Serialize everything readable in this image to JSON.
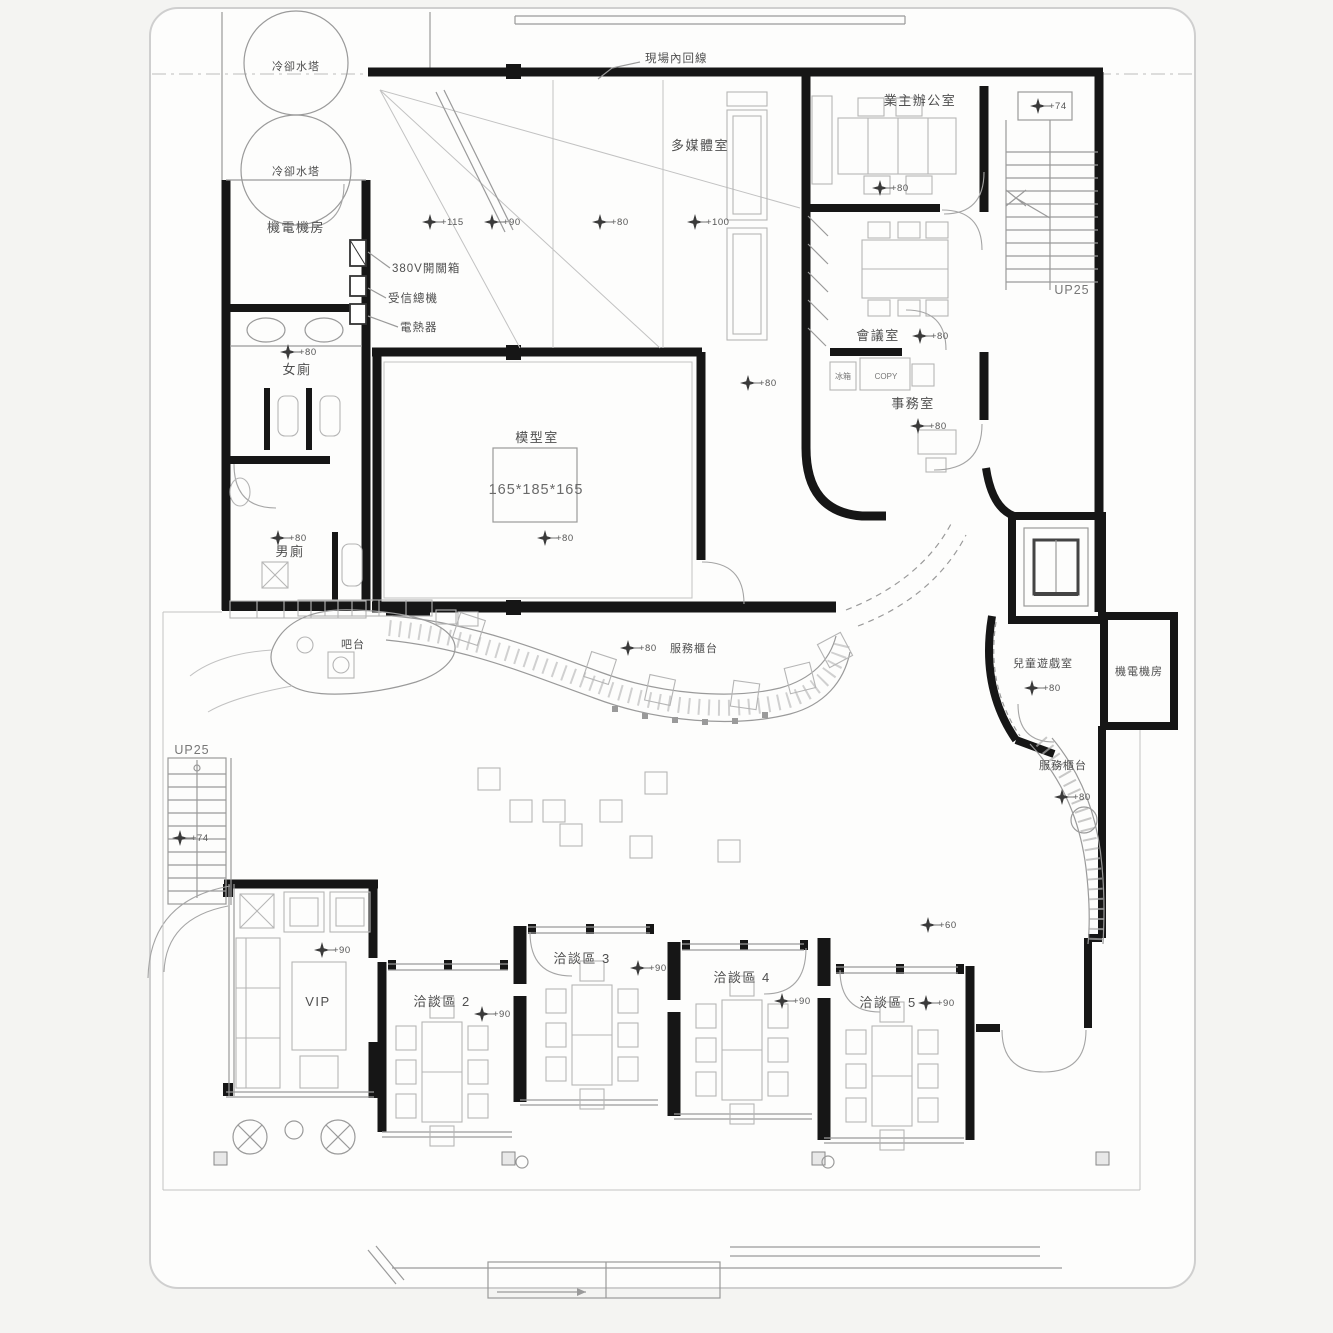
{
  "plan": {
    "title": "floor-plan-drawing",
    "labels": {
      "cooling_tower_1": "冷卻水塔",
      "cooling_tower_2": "冷卻水塔",
      "mech_room_left": "機電機房",
      "switch_box_380v": "380V開關箱",
      "receiver_panel": "受信總機",
      "water_heater": "電熱器",
      "womens_toilet": "女廁",
      "mens_toilet": "男廁",
      "multimedia_room": "多媒體室",
      "site_inner_line": "現場內回線",
      "owner_office": "業主辦公室",
      "meeting_room": "會議室",
      "office_room": "事務室",
      "copy_machine": "COPY",
      "fridge": "冰箱",
      "model_room": "模型室",
      "model_dimensions": "165*185*165",
      "stair_up_right": "UP25",
      "stair_up_left": "UP25",
      "kids_playroom": "兒童遊戲室",
      "mech_room_right": "機電機房",
      "service_counter_right": "服務櫃台",
      "service_counter_mid": "服務櫃台",
      "bar_counter": "吧台",
      "vip_room": "VIP",
      "talk_area_2": "洽談區 2",
      "talk_area_3": "洽談區 3",
      "talk_area_4": "洽談區 4",
      "talk_area_5": "洽談區 5"
    },
    "elevations": {
      "e60": "+60",
      "e74": "+74",
      "e80": "+80",
      "e90": "+90",
      "e100": "+100",
      "e115": "+115"
    },
    "colors": {
      "wall": "#161616",
      "line": "#9a9a9a",
      "furniture": "#b5b5b5",
      "text": "#4f4f4f",
      "paper": "#fdfdfc",
      "background": "#f4f4f2"
    }
  }
}
